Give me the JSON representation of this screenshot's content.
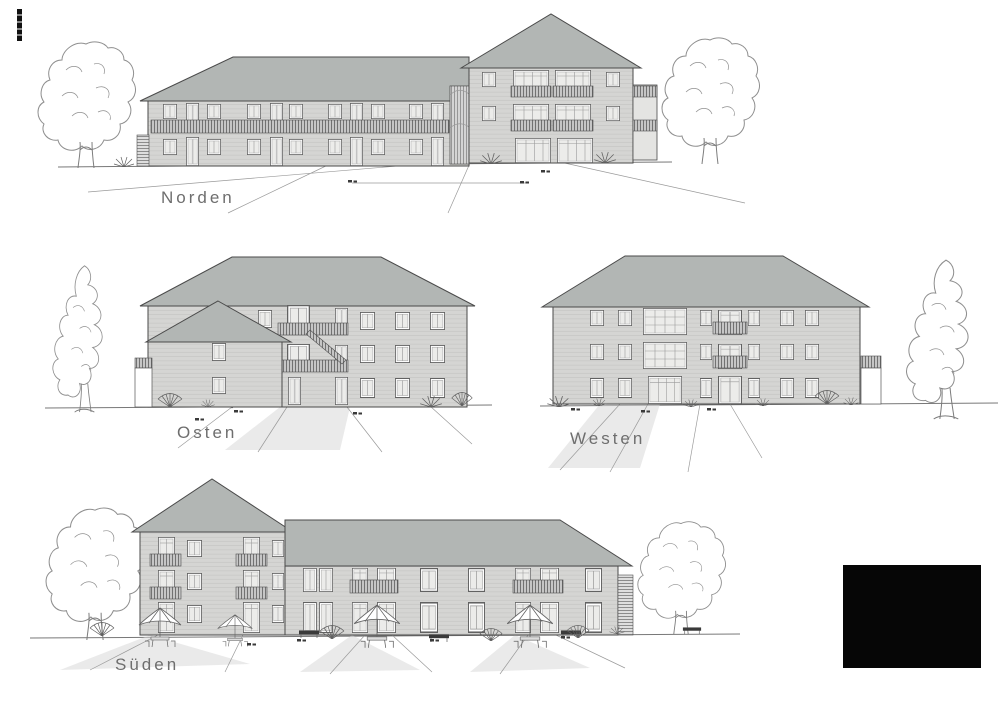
{
  "sheet": {
    "background": "#ffffff"
  },
  "elevations": [
    {
      "id": "norden",
      "label": "Norden"
    },
    {
      "id": "osten",
      "label": "Osten"
    },
    {
      "id": "westen",
      "label": "Westen"
    },
    {
      "id": "sueden",
      "label": "Süden"
    }
  ],
  "colors": {
    "paper": "#ffffff",
    "roof": "#b2b6b4",
    "wall": "#d5d5d3",
    "wallline": "#c1c1bf",
    "glass": "#ececea",
    "frame": "#626262",
    "railbg": "#c6c6c6",
    "railbar": "#4f4f4f",
    "line": "#4a4a4a",
    "groundline": "#787878",
    "label": "#6e6e6e",
    "tree": "#8f8f8f",
    "path": "#d9d9d9",
    "redaction": "#060606"
  },
  "icons": {
    "tree_round": "deciduous-tree-icon",
    "tree_poplar": "poplar-tree-icon",
    "shrub": "shrub-icon",
    "parasol": "parasol-icon",
    "bench": "bench-icon",
    "ladder": "ladder-icon",
    "stair": "external-stair-icon",
    "redaction": "redacted-block",
    "stamp": "corner-stamp"
  }
}
